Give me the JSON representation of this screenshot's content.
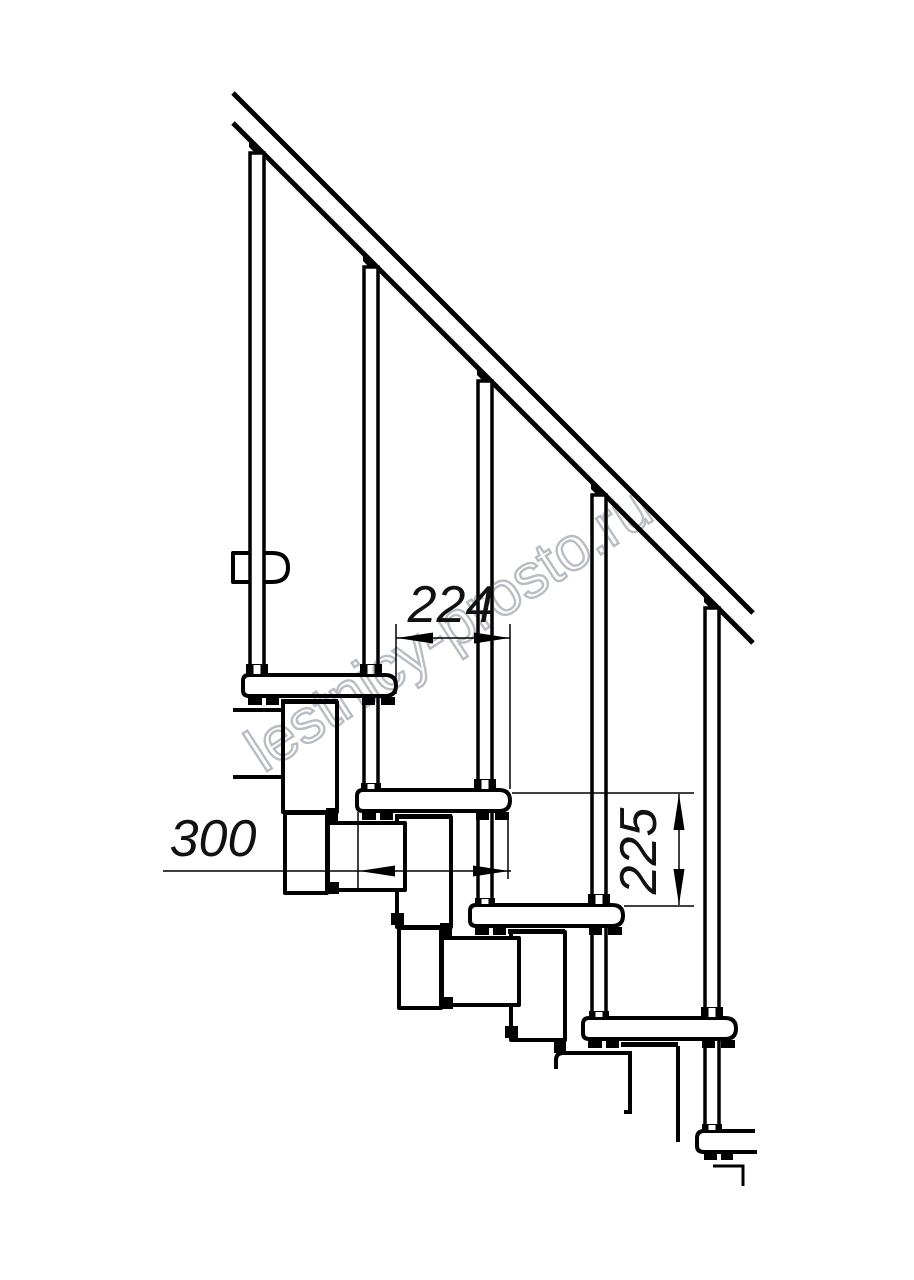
{
  "page": {
    "background": "#ffffff",
    "width": 914,
    "height": 1280
  },
  "drawing": {
    "kind": "modular staircase side-view fragment, black line technical drawing",
    "line_color": "#000000",
    "watermark": {
      "text": "lestnicy-prosto.ru",
      "color": "#b4bac1"
    },
    "dimensions": {
      "going": {
        "label": "224",
        "orientation": "horizontal"
      },
      "tread_depth": {
        "label": "300",
        "orientation": "horizontal"
      },
      "rise": {
        "label": "225",
        "orientation": "vertical"
      }
    },
    "structure": {
      "treads_visible": 5,
      "balusters_visible": 5,
      "handrail": true
    }
  }
}
